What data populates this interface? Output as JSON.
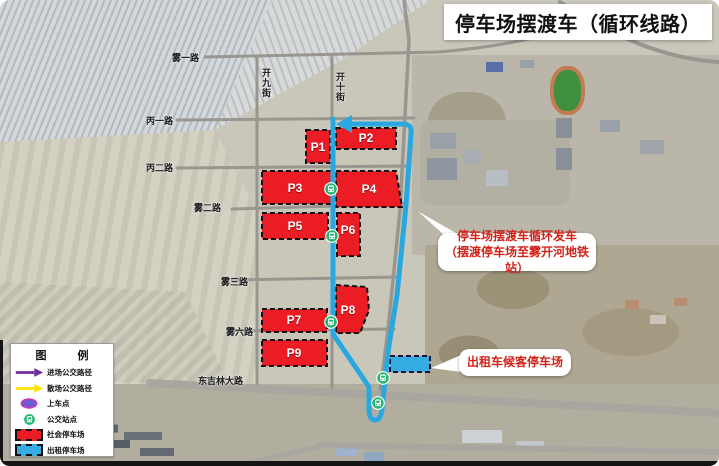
{
  "title": "停车场摆渡车（循环线路）",
  "roads": {
    "wu_yi": "雾一路",
    "kai_jiu": "开九街",
    "kai_shi": "开十街",
    "bing_yi": "丙一路",
    "bing_er": "丙二路",
    "wu_er": "雾二路",
    "wu_san": "雾三路",
    "wu_liu": "雾六路",
    "dong_ji_lin": "东吉林大路"
  },
  "lots": {
    "p1": "P1",
    "p2": "P2",
    "p3": "P3",
    "p4": "P4",
    "p5": "P5",
    "p6": "P6",
    "p7": "P7",
    "p8": "P8",
    "p9": "P9"
  },
  "callouts": {
    "loop_line1": "停车场摆渡车循环发车",
    "loop_line2": "（摆渡停车场至雾开河地铁站）",
    "taxi": "出租车候客停车场"
  },
  "legend": {
    "title": "图　例",
    "items": [
      {
        "label": "进场公交路径",
        "color": "#7030A0"
      },
      {
        "label": "散场公交路径",
        "color": "#FFE500"
      },
      {
        "label": "上车点",
        "color": "#6B5BD2"
      },
      {
        "label": "公交站点",
        "color": "#22B573"
      },
      {
        "label": "社会停车场",
        "color": "#EC1C24"
      },
      {
        "label": "出租停车场",
        "color": "#35ADE3"
      }
    ]
  },
  "colors": {
    "route_blue": "#29A8E0",
    "social_lot_red": "#EC1C24",
    "taxi_lot_blue": "#35ADE3",
    "bus_stop_green": "#22B573",
    "callout_text_red": "#D22318"
  }
}
